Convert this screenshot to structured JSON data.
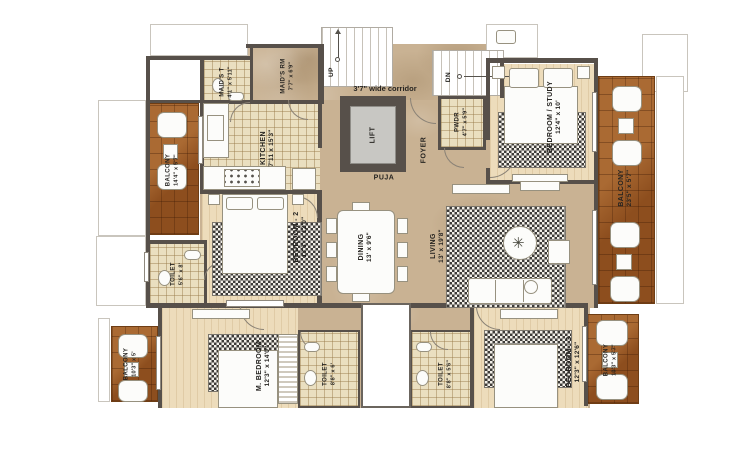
{
  "rooms": {
    "balcony_tl": {
      "name": "BALCONY",
      "dims": "14'4\" x 5'7\""
    },
    "maids_t": {
      "name": "MAID'S T",
      "dims": "4'1\" x 5'11\""
    },
    "maids_rm": {
      "name": "MAID'S RM",
      "dims": "7'7\" x 6'9\""
    },
    "kitchen": {
      "name": "KITCHEN",
      "dims": "7'11 x 15'3\""
    },
    "bedroom2": {
      "name": "BEDROOM - 2",
      "dims": "13'3\" x 12'0\""
    },
    "toilet_bedroom2": {
      "name": "TOILET",
      "dims": "5'6\" x 8'"
    },
    "dining": {
      "name": "DINING",
      "dims": "13' x 9'6\""
    },
    "living": {
      "name": "LIVING",
      "dims": "13' x 19'8\""
    },
    "bedroom_study": {
      "name": "BEDROOM / STUDY",
      "dims": "12'4\" x 10'"
    },
    "balcony_right": {
      "name": "BALCONY",
      "dims": "23'5\" x 5'7\""
    },
    "pwdr": {
      "name": "PWDR",
      "dims": "4'7\" x 5'9\""
    },
    "master_bedroom": {
      "name": "M. BEDROOM",
      "dims": "12'3\" x 14'0\""
    },
    "balcony_bl": {
      "name": "BALCONY",
      "dims": "10'3\" x 5'"
    },
    "toilet_master": {
      "name": "TOILET",
      "dims": "8'8\" x 6'"
    },
    "toilet_bedroom3": {
      "name": "TOILET",
      "dims": "8'8\" x 5'6\""
    },
    "bedroom3": {
      "name": "BEDROOM - 3",
      "dims": "12'3\" x 12'6\""
    },
    "balcony_br": {
      "name": "BALCONY",
      "dims": "10'3\" x 5'7\""
    }
  },
  "core": {
    "lift": "LIFT",
    "puja": "PUJA",
    "foyer": "FOYER",
    "stairs_up": "UP",
    "stairs_down": "DN",
    "corridor_note": "3'7\" wide corridor"
  },
  "colors": {
    "wall": "#57504a",
    "wood_deck": "#9b5b27",
    "marble_floor": "#c9b293",
    "bedroom_floor": "#eddcbb",
    "tile_floor": "#eadfc0",
    "rug_dark": "#3d3b38"
  }
}
